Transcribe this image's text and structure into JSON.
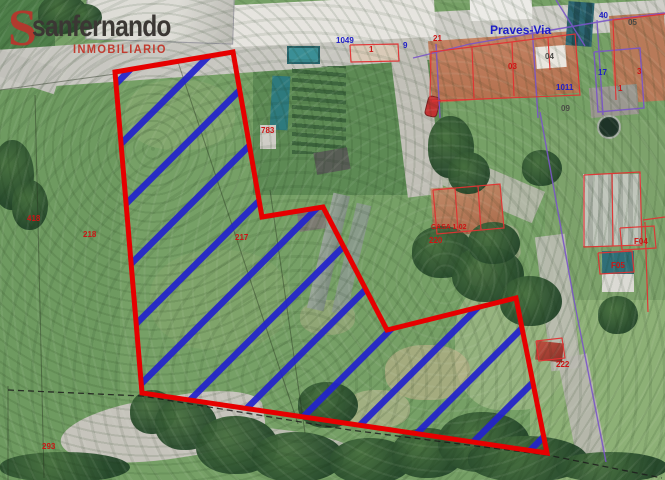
{
  "branding": {
    "initial": "S",
    "name": "sanfernando",
    "subtitle": "INMOBILIARIO",
    "initial_color": "#b13a2e",
    "name_color": "#3b3734",
    "subtitle_color": "#c23b2f"
  },
  "map": {
    "street_label": "Praves-Via",
    "parcel": {
      "outline_points": "115,72 233,52 262,217 323,207 387,330 516,298 547,453 142,393",
      "outline_color": "#e60000",
      "hatch_color": "#2222cc"
    },
    "label_colors": {
      "red": "#cc1414",
      "blue": "#1d1dc8",
      "dark": "#4a4a46"
    },
    "labels": [
      {
        "text": "21",
        "x": 433,
        "y": 35,
        "color": "red"
      },
      {
        "text": "1049",
        "x": 336,
        "y": 37,
        "color": "blue"
      },
      {
        "text": "9",
        "x": 403,
        "y": 42,
        "color": "blue"
      },
      {
        "text": "Praves-Via",
        "x": 490,
        "y": 24,
        "color": "blue",
        "size": 12,
        "bold": true
      },
      {
        "text": "40",
        "x": 599,
        "y": 12,
        "color": "blue"
      },
      {
        "text": "05",
        "x": 628,
        "y": 19,
        "color": "dark"
      },
      {
        "text": "03",
        "x": 508,
        "y": 63,
        "color": "red"
      },
      {
        "text": "04",
        "x": 545,
        "y": 53,
        "color": "dark"
      },
      {
        "text": "3",
        "x": 637,
        "y": 68,
        "color": "red"
      },
      {
        "text": "17",
        "x": 598,
        "y": 69,
        "color": "blue"
      },
      {
        "text": "1011",
        "x": 556,
        "y": 84,
        "color": "blue"
      },
      {
        "text": "1",
        "x": 618,
        "y": 85,
        "color": "red"
      },
      {
        "text": "09",
        "x": 561,
        "y": 105,
        "color": "dark"
      },
      {
        "text": "1",
        "x": 369,
        "y": 46,
        "color": "red"
      },
      {
        "text": "783",
        "x": 261,
        "y": 127,
        "color": "red"
      },
      {
        "text": "418",
        "x": 27,
        "y": 215,
        "color": "red"
      },
      {
        "text": "218",
        "x": 83,
        "y": 231,
        "color": "red"
      },
      {
        "text": "217",
        "x": 235,
        "y": 234,
        "color": "red"
      },
      {
        "text": "CASA 1-02",
        "x": 431,
        "y": 224,
        "color": "red",
        "size": 7
      },
      {
        "text": "220",
        "x": 429,
        "y": 237,
        "color": "red"
      },
      {
        "text": "F04",
        "x": 634,
        "y": 238,
        "color": "red"
      },
      {
        "text": "F05",
        "x": 611,
        "y": 262,
        "color": "red"
      },
      {
        "text": "222",
        "x": 556,
        "y": 361,
        "color": "red"
      },
      {
        "text": "293",
        "x": 42,
        "y": 443,
        "color": "red"
      }
    ]
  }
}
